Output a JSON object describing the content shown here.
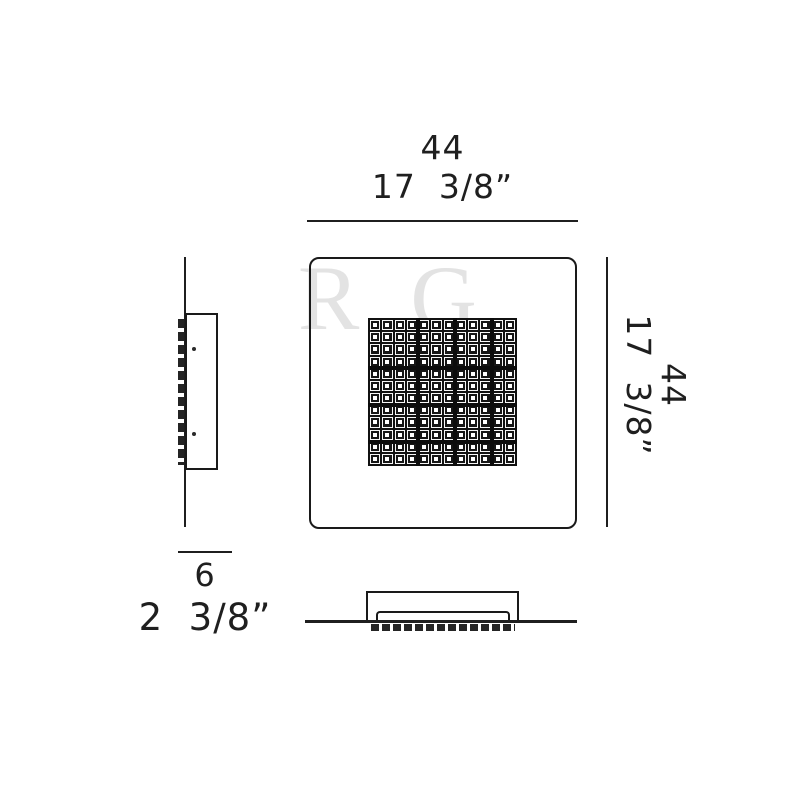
{
  "drawing": {
    "watermark": "R G",
    "dim_width": {
      "metric": "44",
      "imperial": "17  3/8”"
    },
    "dim_height": {
      "metric": "44",
      "imperial": "17  3/8”"
    },
    "dim_depth": {
      "metric": "6",
      "imperial": "2  3/8”"
    },
    "crystal_grid": {
      "rows": 12,
      "cols": 12
    }
  }
}
